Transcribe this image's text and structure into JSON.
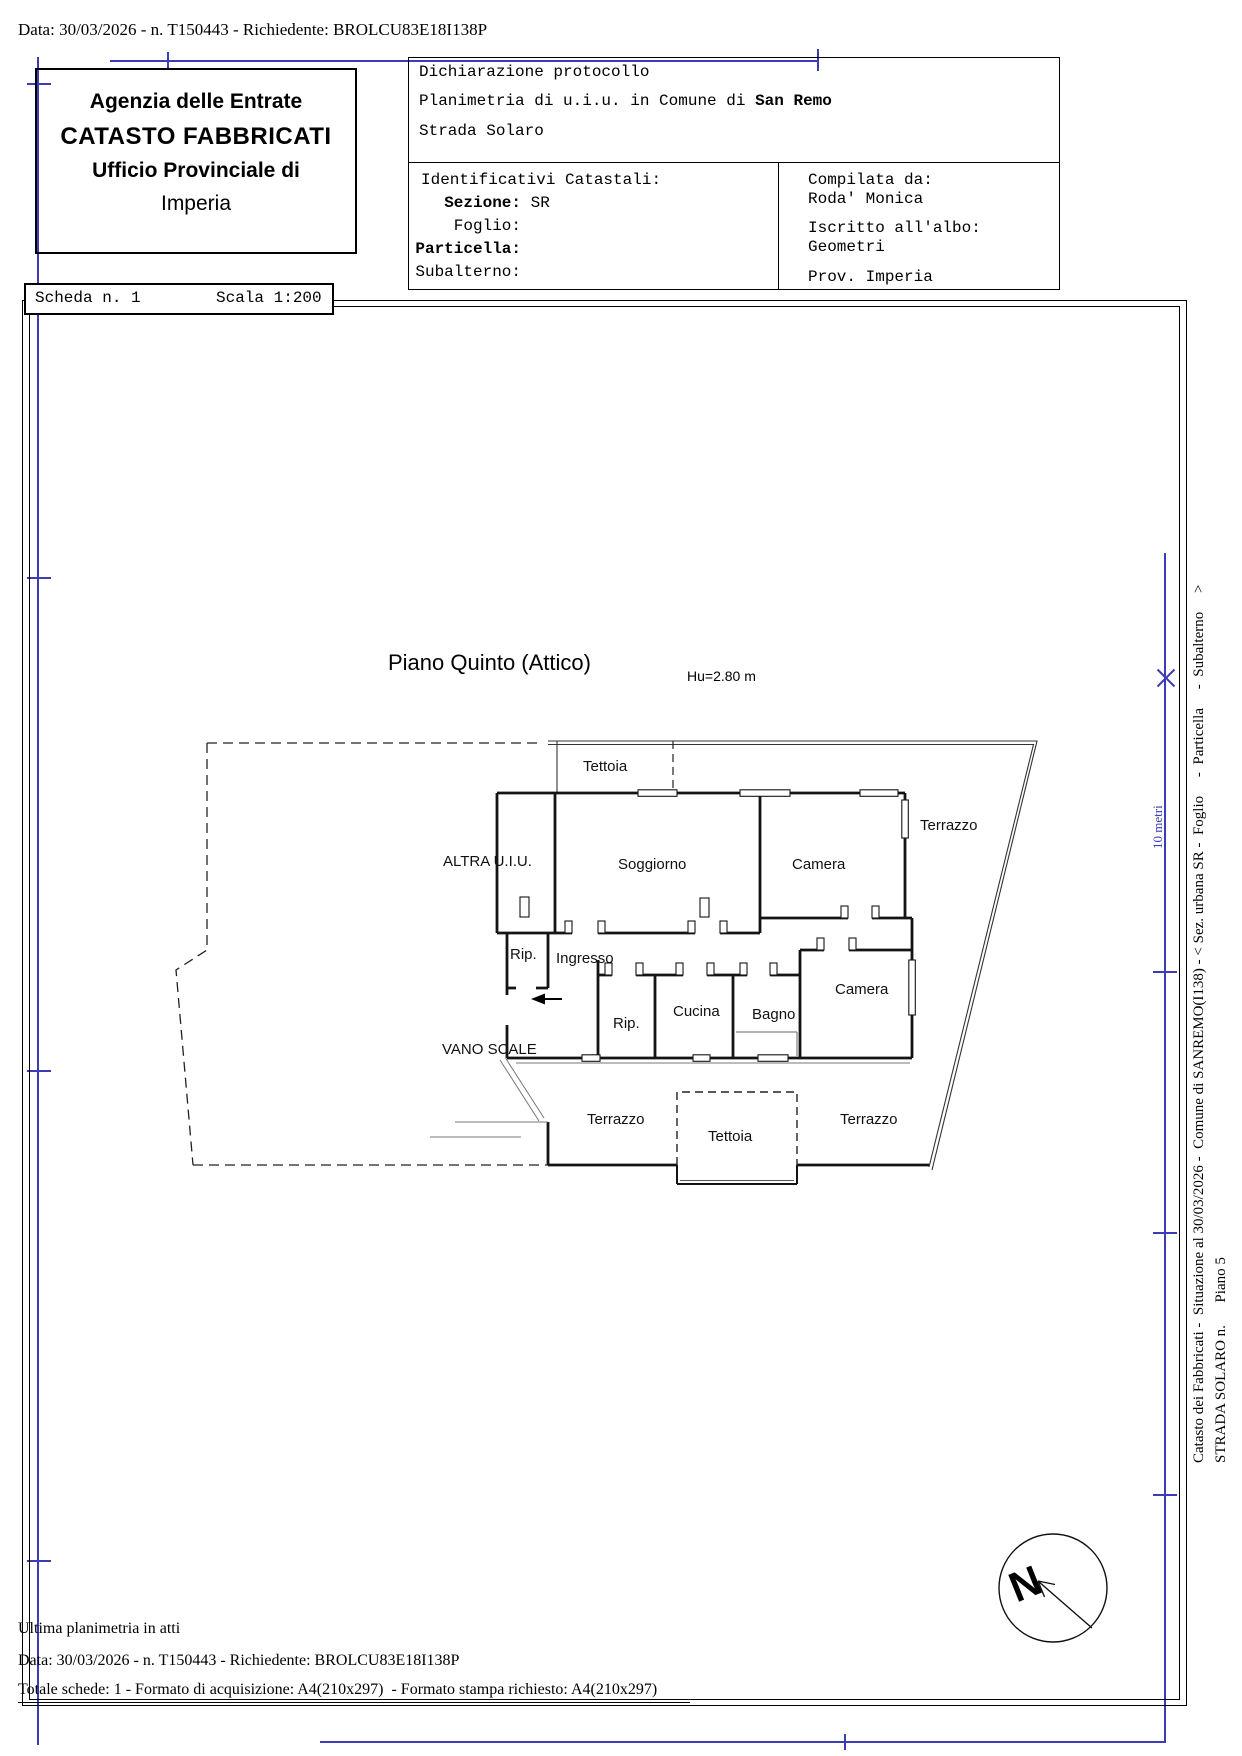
{
  "colors": {
    "accent_blue": "#3c3cb4",
    "line_black": "#141414"
  },
  "top_bar": {
    "request_line": "Data: 30/03/2026 - n. T150443 - Richiedente: BROLCU83E18I138P"
  },
  "agency_box": {
    "line1": "Agenzia delle Entrate",
    "line2": "CATASTO FABBRICATI",
    "line3": "Ufficio Provinciale di",
    "line4": "Imperia"
  },
  "scheda_box": {
    "scheda": "Scheda n. 1",
    "scala": "Scala 1:200"
  },
  "declaration_box": {
    "title": "Dichiarazione protocollo",
    "line2_prefix": "Planimetria di u.i.u. in Comune di ",
    "line2_comune": "San Remo",
    "line3": "Strada Solaro",
    "identifiers": {
      "heading": "Identificativi Catastali:",
      "rows": [
        {
          "label": "Sezione:",
          "value": "SR"
        },
        {
          "label": "Foglio:",
          "value": ""
        },
        {
          "label": "Particella:",
          "value": ""
        },
        {
          "label": "Subalterno:",
          "value": ""
        }
      ]
    },
    "compiler": {
      "label": "Compilata da:",
      "name": "Roda' Monica",
      "albo_label": "Iscritto all'albo:",
      "albo": "Geometri",
      "prov": "Prov. Imperia"
    }
  },
  "plan": {
    "title": "Piano Quinto (Attico)",
    "height_note": "Hu=2.80 m",
    "rooms": [
      {
        "label": "Tettoia",
        "x": 583,
        "y": 758
      },
      {
        "label": "ALTRA U.I.U.",
        "x": 443,
        "y": 853
      },
      {
        "label": "Soggiorno",
        "x": 618,
        "y": 856
      },
      {
        "label": "Camera",
        "x": 792,
        "y": 856
      },
      {
        "label": "Terrazzo",
        "x": 920,
        "y": 817
      },
      {
        "label": "Rip.",
        "x": 510,
        "y": 946
      },
      {
        "label": "Ingresso",
        "x": 556,
        "y": 950
      },
      {
        "label": "Rip.",
        "x": 613,
        "y": 1015
      },
      {
        "label": "Cucina",
        "x": 673,
        "y": 1003
      },
      {
        "label": "Bagno",
        "x": 752,
        "y": 1006
      },
      {
        "label": "Camera",
        "x": 835,
        "y": 981
      },
      {
        "label": "VANO SCALE",
        "x": 442,
        "y": 1041
      },
      {
        "label": "Terrazzo",
        "x": 587,
        "y": 1111
      },
      {
        "label": "Tettoia",
        "x": 708,
        "y": 1128
      },
      {
        "label": "Terrazzo",
        "x": 840,
        "y": 1111
      }
    ]
  },
  "scale_ruler": {
    "label": "10 metri"
  },
  "side_captions": {
    "line1": "Catasto dei Fabbricati -  Situazione al 30/03/2026 -  Comune di SANREMO(I138) - < Sez. urbana SR -  Foglio     -  Particella     -  Subalterno     >",
    "line2": "STRADA SOLARO n.      Piano 5"
  },
  "compass": {
    "label": "N"
  },
  "footer": {
    "line1": "Ultima planimetria in atti",
    "line2": "Data: 30/03/2026 - n. T150443 - Richiedente: BROLCU83E18I138P",
    "line3": "Totale schede: 1 - Formato di acquisizione: A4(210x297)  - Formato stampa richiesto: A4(210x297)"
  }
}
